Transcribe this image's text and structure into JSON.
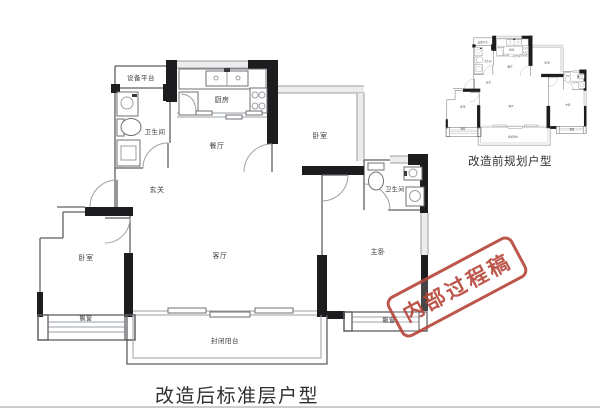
{
  "main_plan": {
    "caption": "改造后标准层户型",
    "rooms": {
      "equipment_platform": "设备平台",
      "bathroom_left": "卫生间",
      "kitchen": "厨房",
      "dining": "餐厅",
      "bedroom_top": "卧室",
      "bathroom_right": "卫生间",
      "entry": "玄关",
      "bedroom_left": "卧室",
      "living": "客厅",
      "master_bedroom": "主卧",
      "bay_window_left": "飘窗",
      "bay_window_right": "飘窗",
      "balcony": "封闭阳台"
    }
  },
  "small_plan": {
    "caption": "改造前规划户型"
  },
  "stamp": {
    "text": "内部过程稿",
    "color": "#b8493d"
  },
  "colors": {
    "wall": "#1d1d20",
    "thin_line": "#5f5f63",
    "window_line": "#9aa0a6",
    "window_fill": "#ececec",
    "label_text": "#3c3c40",
    "caption_text": "#2f2f31",
    "divider": "#c9cdd1",
    "background": "#ffffff"
  }
}
